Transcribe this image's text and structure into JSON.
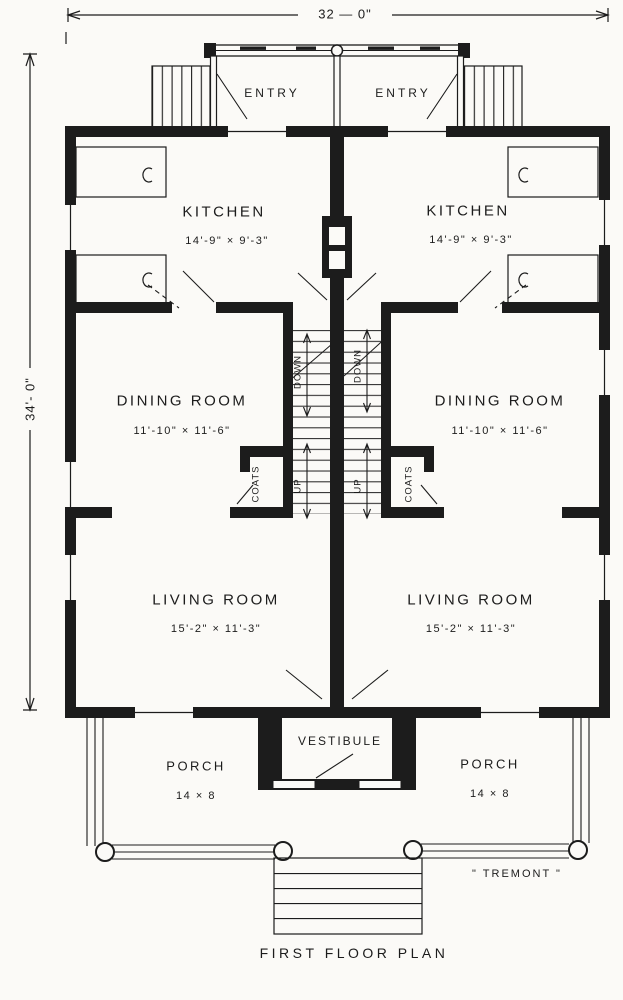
{
  "dimensions": {
    "width_label": "32 — 0\"",
    "height_label": "34'- 0\""
  },
  "units": {
    "left": {
      "entry": "ENTRY",
      "kitchen": "KITCHEN",
      "kitchen_size": "14'-9\" × 9'-3\"",
      "dining": "DINING ROOM",
      "dining_size": "11'-10\" × 11'-6\"",
      "living": "LIVING ROOM",
      "living_size": "15'-2\" × 11'-3\"",
      "coats": "COATS",
      "stair_down": "DOWN",
      "stair_up": "UP",
      "porch": "PORCH",
      "porch_size": "14 × 8"
    },
    "right": {
      "entry": "ENTRY",
      "kitchen": "KITCHEN",
      "kitchen_size": "14'-9\" × 9'-3\"",
      "dining": "DINING ROOM",
      "dining_size": "11'-10\" × 11'-6\"",
      "living": "LIVING ROOM",
      "living_size": "15'-2\" × 11'-3\"",
      "coats": "COATS",
      "stair_down": "DOWN",
      "stair_up": "UP",
      "porch": "PORCH",
      "porch_size": "14 × 8"
    }
  },
  "shared": {
    "vestibule": "VESTIBULE"
  },
  "footer": {
    "house_name": "\" TREMONT \"",
    "caption": "FIRST FLOOR PLAN"
  },
  "colors": {
    "ink": "#1c1c1c",
    "paper": "#fbfaf7"
  }
}
